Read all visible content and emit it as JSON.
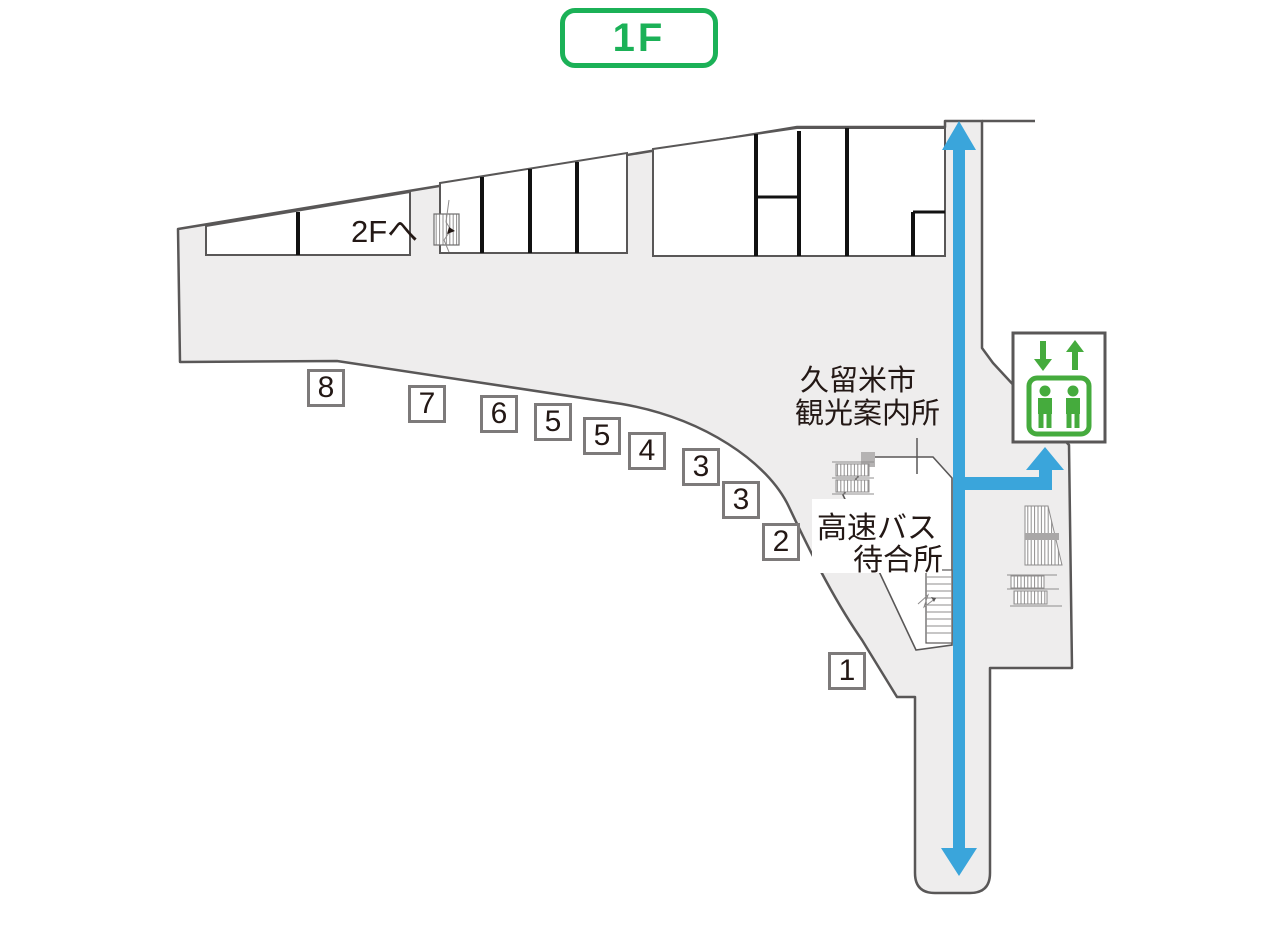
{
  "floor_badge": {
    "label": "1F"
  },
  "labels": {
    "to_2f": "2Fへ",
    "info_center": {
      "line1": "久留米市",
      "line2": "観光案内所"
    },
    "bus_waiting": {
      "line1": "高速バス",
      "line2": "待合所"
    }
  },
  "bus_stops": [
    {
      "number": "8"
    },
    {
      "number": "7"
    },
    {
      "number": "6"
    },
    {
      "number": "5"
    },
    {
      "number": "5"
    },
    {
      "number": "4"
    },
    {
      "number": "3"
    },
    {
      "number": "3"
    },
    {
      "number": "2"
    },
    {
      "number": "1"
    }
  ],
  "icons": {
    "elevator": "elevator-icon",
    "stairs_to_2f": "stairs-icon",
    "escalators": "escalator-icon",
    "route_arrows": "route-arrow-icon"
  },
  "colors": {
    "badge_green": "#1bb157",
    "elevator_green": "#45ab3d",
    "route_blue": "#3aa5db",
    "wall_gray": "#595757",
    "floor_gray": "#eeeded",
    "box_border": "#7d7a7a",
    "text_dark": "#231815"
  }
}
